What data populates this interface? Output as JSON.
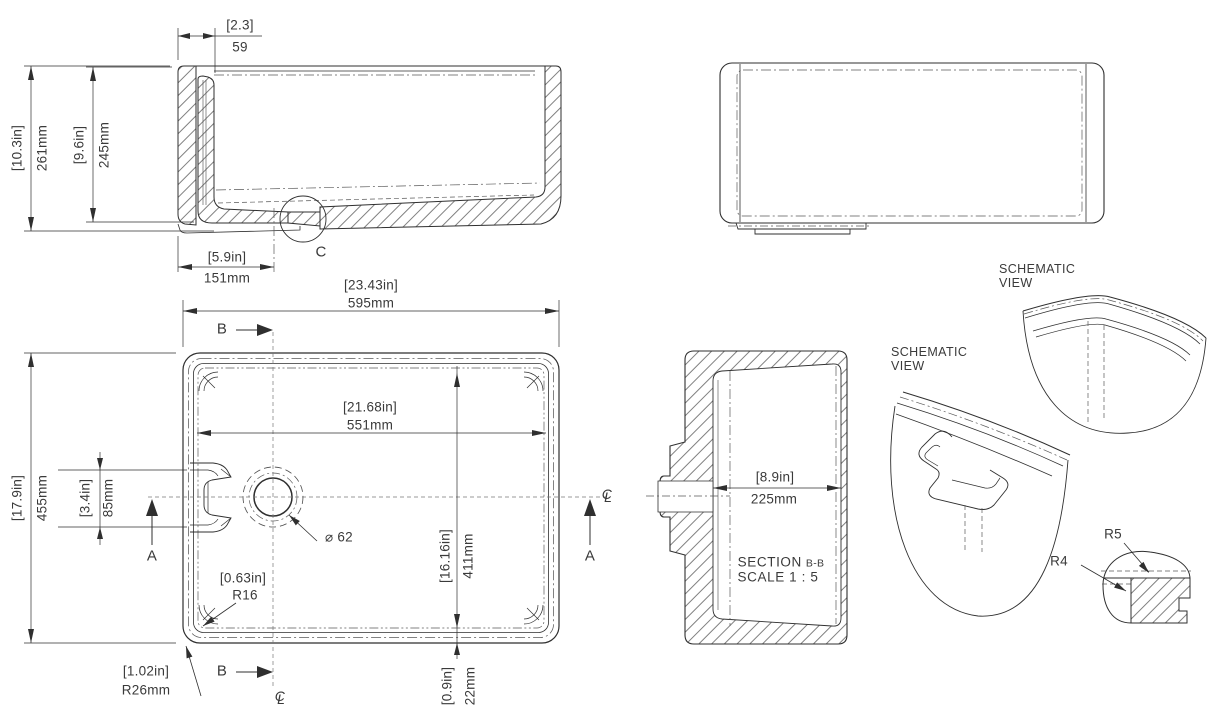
{
  "colors": {
    "background": "#ffffff",
    "line": "#2f2f2f",
    "text": "#3a3a3a"
  },
  "drawing": {
    "side_section": {
      "lip_in": "[2.3]",
      "lip_mm": "59",
      "height_in": "[10.3in]",
      "height_mm": "261mm",
      "depth_in": "[9.6in]",
      "depth_mm": "245mm",
      "drain_offset_in": "[5.9in]",
      "drain_offset_mm": "151mm",
      "detail_label": "C"
    },
    "front_view": {
      "width_in": "[23.43in]",
      "width_mm": "595mm",
      "inner_width_in": "[21.68in]",
      "inner_width_mm": "551mm",
      "height_in": "[17.9in]",
      "height_mm": "455mm",
      "weir_in": "[3.4in]",
      "weir_mm": "85mm",
      "inner_height_in": "[16.16in]",
      "inner_height_mm": "411mm",
      "base_in": "[0.9in]",
      "base_mm": "22mm",
      "inner_corner_in": "[0.63in]",
      "inner_corner_mm": "R16",
      "outer_corner_in": "[1.02in]",
      "outer_corner_mm": "R26mm",
      "drain_dia": "⌀ 62",
      "marker_a": "A",
      "marker_b": "B",
      "cl_c": "C",
      "cl_l": "L"
    },
    "section_bb": {
      "width_in": "[8.9in]",
      "width_mm": "225mm",
      "title": "SECTION",
      "title_ref": "B-B",
      "scale": "SCALE 1 : 5"
    },
    "schematic_view_1": {
      "line1": "SCHEMATIC",
      "line2": "VIEW"
    },
    "schematic_view_2": {
      "line1": "SCHEMATIC",
      "line2": "VIEW"
    },
    "detail_c": {
      "r5": "R5",
      "r4": "R4"
    }
  }
}
